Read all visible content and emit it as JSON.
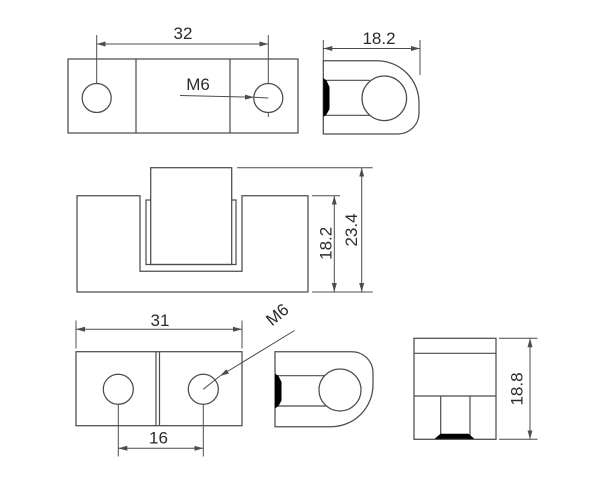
{
  "drawing": {
    "type": "technical-drawing",
    "subject": "hinge with M6 threaded holes, six orthographic views",
    "colors": {
      "background": "#ffffff",
      "line": "#4c4c4c",
      "text": "#2b2b2b",
      "section_fill": "#000000"
    },
    "labels": {
      "top_plan": {
        "hole_spacing": "32",
        "thread": "M6"
      },
      "top_side": {
        "width": "18.2"
      },
      "front_assembled": {
        "body_height": "18.2",
        "total_height": "23.4"
      },
      "bottom_plan": {
        "width": "31",
        "hole_spacing": "16",
        "thread": "M6"
      },
      "bottom_section": {
        "height": "18.8"
      }
    }
  }
}
